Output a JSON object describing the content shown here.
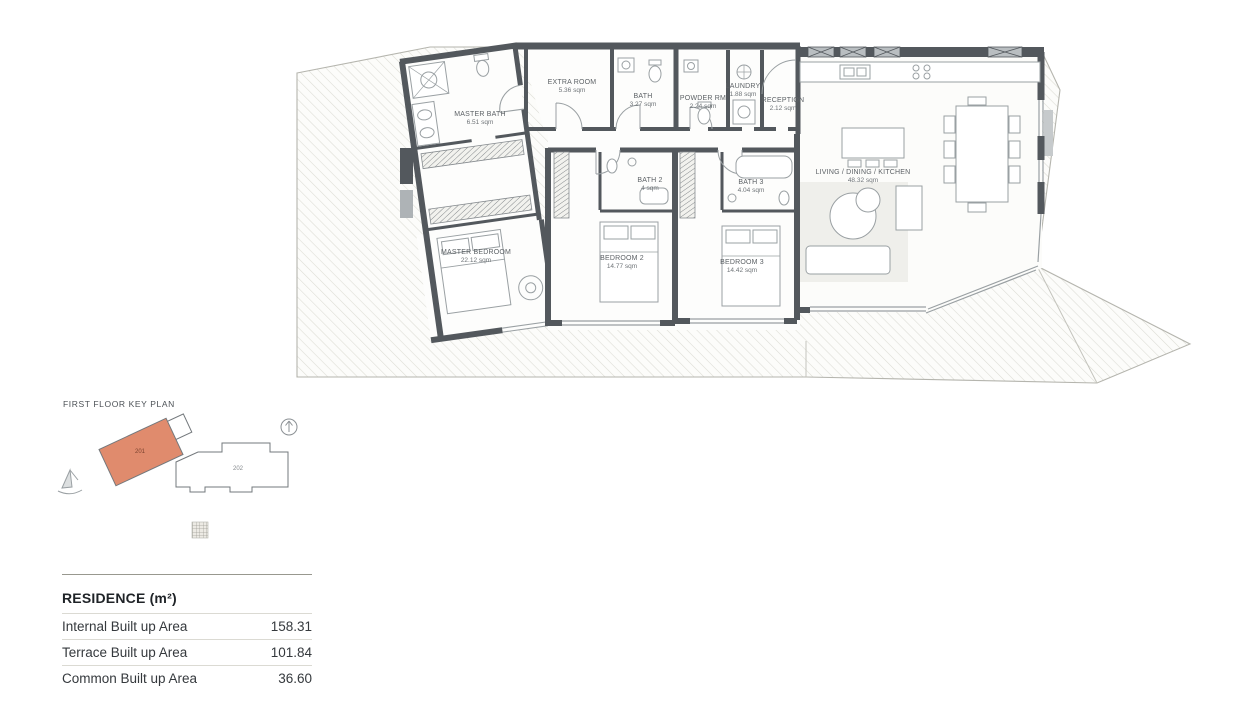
{
  "floor_plan": {
    "rooms": [
      {
        "id": "master-bath",
        "name": "MASTER BATH",
        "area": "6.51 sqm"
      },
      {
        "id": "extra-room",
        "name": "EXTRA ROOM",
        "area": "5.36 sqm"
      },
      {
        "id": "bath",
        "name": "BATH",
        "area": "3.27 sqm"
      },
      {
        "id": "powder-rm",
        "name": "POWDER RM",
        "area": "2.24 sqm"
      },
      {
        "id": "laundry",
        "name": "LAUNDRY",
        "area": "1.88 sqm"
      },
      {
        "id": "reception",
        "name": "RECEPTION",
        "area": "2.12 sqm"
      },
      {
        "id": "living",
        "name": "LIVING / DINING / KITCHEN",
        "area": "48.32 sqm"
      },
      {
        "id": "master-bedroom",
        "name": "MASTER BEDROOM",
        "area": "22.12 sqm"
      },
      {
        "id": "bedroom-2",
        "name": "BEDROOM 2",
        "area": "14.77 sqm"
      },
      {
        "id": "bedroom-3",
        "name": "BEDROOM 3",
        "area": "14.42 sqm"
      },
      {
        "id": "bath-2",
        "name": "BATH 2",
        "area": "4 sqm"
      },
      {
        "id": "bath-3",
        "name": "BATH 3",
        "area": "4.04 sqm"
      }
    ]
  },
  "key_plan": {
    "title": "FIRST FLOOR KEY PLAN",
    "units": [
      {
        "number": "201",
        "highlighted": true
      },
      {
        "number": "202",
        "highlighted": false
      }
    ],
    "highlight_color": "#E08B6D"
  },
  "residence_table": {
    "title": "RESIDENCE (m²)",
    "rows": [
      {
        "label": "Internal Built up Area",
        "value": "158.31"
      },
      {
        "label": "Terrace Built up Area",
        "value": "101.84"
      },
      {
        "label": "Common Built up Area",
        "value": "36.60"
      }
    ]
  },
  "colors": {
    "wall": "#53585D",
    "hatch_line": "#DCDCD4",
    "terrace_outline": "#B5B5AE",
    "highlight": "#E08B6D",
    "text": "#35393D"
  }
}
